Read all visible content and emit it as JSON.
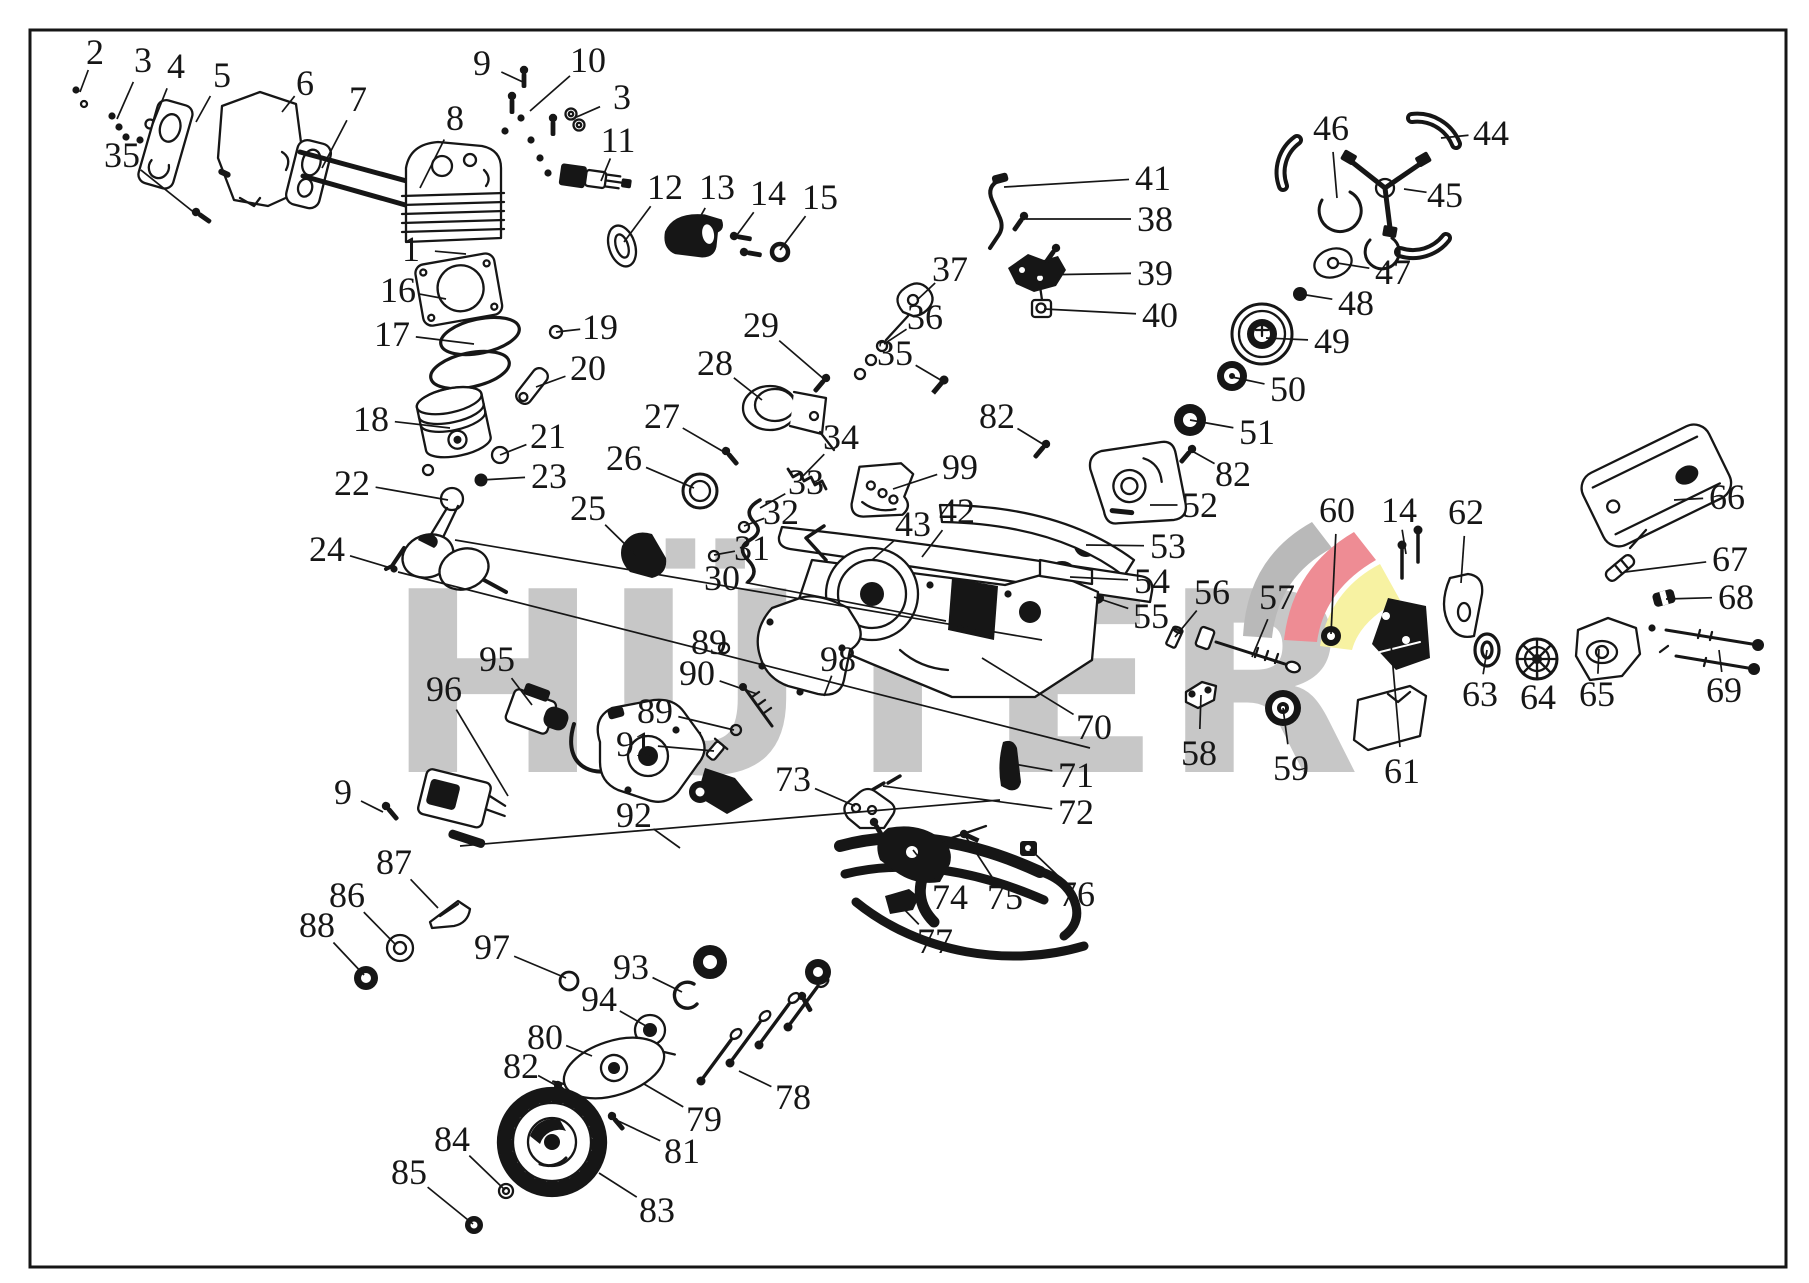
{
  "diagram": {
    "type": "exploded-parts-diagram",
    "subject": "chainsaw engine parts",
    "watermark": {
      "text": "HÜTER",
      "color": "#c7c7c7"
    },
    "logo_colors": {
      "gray": "#b9b9b9",
      "red": "#ee8c94",
      "yellow": "#f7f2a2"
    },
    "line_color": "#161616",
    "background": "#ffffff",
    "callouts": [
      {
        "n": "2",
        "l": [
          95,
          52
        ],
        "p": [
          80,
          92
        ]
      },
      {
        "n": "3",
        "l": [
          143,
          60
        ],
        "p": [
          117,
          119
        ]
      },
      {
        "n": "4",
        "l": [
          176,
          66
        ],
        "p": [
          152,
          126
        ]
      },
      {
        "n": "5",
        "l": [
          222,
          75
        ],
        "p": [
          196,
          122
        ]
      },
      {
        "n": "6",
        "l": [
          305,
          83
        ],
        "p": [
          282,
          112
        ]
      },
      {
        "n": "7",
        "l": [
          358,
          99
        ],
        "p": [
          322,
          168
        ]
      },
      {
        "n": "8",
        "l": [
          455,
          118
        ],
        "p": [
          420,
          188
        ]
      },
      {
        "n": "35",
        "l": [
          122,
          155
        ],
        "p": [
          196,
          214
        ]
      },
      {
        "n": "9",
        "l": [
          482,
          63
        ],
        "p": [
          525,
          83
        ]
      },
      {
        "n": "10",
        "l": [
          588,
          60
        ],
        "p": [
          530,
          111
        ]
      },
      {
        "n": "3",
        "l": [
          622,
          97
        ],
        "p": [
          572,
          119
        ]
      },
      {
        "n": "11",
        "l": [
          618,
          140
        ],
        "p": [
          601,
          181
        ]
      },
      {
        "n": "12",
        "l": [
          665,
          187
        ],
        "p": [
          624,
          242
        ]
      },
      {
        "n": "13",
        "l": [
          717,
          187
        ],
        "p": [
          686,
          242
        ]
      },
      {
        "n": "14",
        "l": [
          768,
          193
        ],
        "p": [
          734,
          239
        ]
      },
      {
        "n": "15",
        "l": [
          820,
          197
        ],
        "p": [
          780,
          250
        ]
      },
      {
        "n": "1",
        "l": [
          411,
          249
        ],
        "p": [
          466,
          254
        ]
      },
      {
        "n": "16",
        "l": [
          398,
          290
        ],
        "p": [
          446,
          299
        ]
      },
      {
        "n": "17",
        "l": [
          392,
          334
        ],
        "p": [
          474,
          344
        ]
      },
      {
        "n": "18",
        "l": [
          371,
          419
        ],
        "p": [
          450,
          428
        ]
      },
      {
        "n": "19",
        "l": [
          600,
          327
        ],
        "p": [
          556,
          332
        ]
      },
      {
        "n": "20",
        "l": [
          588,
          368
        ],
        "p": [
          536,
          387
        ]
      },
      {
        "n": "21",
        "l": [
          548,
          436
        ],
        "p": [
          500,
          455
        ]
      },
      {
        "n": "23",
        "l": [
          549,
          476
        ],
        "p": [
          481,
          480
        ]
      },
      {
        "n": "22",
        "l": [
          352,
          483
        ],
        "p": [
          448,
          500
        ]
      },
      {
        "n": "24",
        "l": [
          327,
          549
        ],
        "p": [
          394,
          569
        ]
      },
      {
        "n": "25",
        "l": [
          588,
          508
        ],
        "p": [
          636,
          555
        ]
      },
      {
        "n": "26",
        "l": [
          624,
          458
        ],
        "p": [
          694,
          488
        ]
      },
      {
        "n": "27",
        "l": [
          662,
          416
        ],
        "p": [
          724,
          452
        ]
      },
      {
        "n": "28",
        "l": [
          715,
          363
        ],
        "p": [
          762,
          400
        ]
      },
      {
        "n": "29",
        "l": [
          761,
          325
        ],
        "p": [
          825,
          380
        ]
      },
      {
        "n": "34",
        "l": [
          841,
          437
        ],
        "p": [
          802,
          477
        ]
      },
      {
        "n": "33",
        "l": [
          806,
          482
        ],
        "p": [
          760,
          508
        ]
      },
      {
        "n": "32",
        "l": [
          781,
          512
        ],
        "p": [
          744,
          526
        ]
      },
      {
        "n": "31",
        "l": [
          752,
          548
        ],
        "p": [
          714,
          555
        ]
      },
      {
        "n": "30",
        "l": [
          722,
          578
        ],
        "p": [
          946,
          621
        ]
      },
      {
        "n": "43",
        "l": [
          913,
          524
        ],
        "p": [
          872,
          560
        ]
      },
      {
        "n": "42",
        "l": [
          957,
          511
        ],
        "p": [
          922,
          557
        ]
      },
      {
        "n": "99",
        "l": [
          960,
          467
        ],
        "p": [
          893,
          489
        ]
      },
      {
        "n": "82",
        "l": [
          997,
          416
        ],
        "p": [
          1046,
          446
        ]
      },
      {
        "n": "82",
        "l": [
          1233,
          474
        ],
        "p": [
          1192,
          451
        ]
      },
      {
        "n": "37",
        "l": [
          950,
          269
        ],
        "p": [
          917,
          300
        ]
      },
      {
        "n": "36",
        "l": [
          925,
          317
        ],
        "p": [
          884,
          344
        ]
      },
      {
        "n": "35",
        "l": [
          895,
          353
        ],
        "p": [
          944,
          382
        ]
      },
      {
        "n": "41",
        "l": [
          1153,
          178
        ],
        "p": [
          1004,
          187
        ]
      },
      {
        "n": "38",
        "l": [
          1155,
          219
        ],
        "p": [
          1026,
          219
        ]
      },
      {
        "n": "39",
        "l": [
          1155,
          273
        ],
        "p": [
          1034,
          275
        ]
      },
      {
        "n": "40",
        "l": [
          1160,
          315
        ],
        "p": [
          1044,
          309
        ]
      },
      {
        "n": "46",
        "l": [
          1331,
          128
        ],
        "p": [
          1337,
          198
        ]
      },
      {
        "n": "44",
        "l": [
          1491,
          133
        ],
        "p": [
          1441,
          138
        ]
      },
      {
        "n": "45",
        "l": [
          1445,
          195
        ],
        "p": [
          1404,
          189
        ]
      },
      {
        "n": "47",
        "l": [
          1393,
          272
        ],
        "p": [
          1337,
          263
        ]
      },
      {
        "n": "48",
        "l": [
          1356,
          303
        ],
        "p": [
          1300,
          294
        ]
      },
      {
        "n": "49",
        "l": [
          1332,
          341
        ],
        "p": [
          1266,
          338
        ]
      },
      {
        "n": "50",
        "l": [
          1288,
          389
        ],
        "p": [
          1232,
          377
        ]
      },
      {
        "n": "51",
        "l": [
          1257,
          432
        ],
        "p": [
          1190,
          420
        ]
      },
      {
        "n": "52",
        "l": [
          1200,
          505
        ],
        "p": [
          1150,
          505
        ]
      },
      {
        "n": "53",
        "l": [
          1168,
          546
        ],
        "p": [
          1086,
          545
        ]
      },
      {
        "n": "54",
        "l": [
          1152,
          581
        ],
        "p": [
          1070,
          577
        ]
      },
      {
        "n": "55",
        "l": [
          1151,
          616
        ],
        "p": [
          1094,
          597
        ]
      },
      {
        "n": "56",
        "l": [
          1212,
          592
        ],
        "p": [
          1175,
          637
        ]
      },
      {
        "n": "57",
        "l": [
          1277,
          597
        ],
        "p": [
          1252,
          657
        ]
      },
      {
        "n": "60",
        "l": [
          1337,
          510
        ],
        "p": [
          1331,
          634
        ]
      },
      {
        "n": "14",
        "l": [
          1399,
          510
        ],
        "p": [
          1406,
          554
        ]
      },
      {
        "n": "62",
        "l": [
          1466,
          512
        ],
        "p": [
          1461,
          583
        ]
      },
      {
        "n": "66",
        "l": [
          1727,
          497
        ],
        "p": [
          1674,
          500
        ]
      },
      {
        "n": "67",
        "l": [
          1730,
          559
        ],
        "p": [
          1625,
          572
        ]
      },
      {
        "n": "68",
        "l": [
          1736,
          597
        ],
        "p": [
          1666,
          599
        ]
      },
      {
        "n": "69",
        "l": [
          1724,
          690
        ],
        "p": [
          1719,
          650
        ]
      },
      {
        "n": "63",
        "l": [
          1480,
          694
        ],
        "p": [
          1487,
          650
        ]
      },
      {
        "n": "64",
        "l": [
          1538,
          697
        ],
        "p": [
          1537,
          660
        ]
      },
      {
        "n": "65",
        "l": [
          1597,
          694
        ],
        "p": [
          1599,
          649
        ]
      },
      {
        "n": "58",
        "l": [
          1199,
          753
        ],
        "p": [
          1201,
          695
        ]
      },
      {
        "n": "59",
        "l": [
          1291,
          768
        ],
        "p": [
          1283,
          708
        ]
      },
      {
        "n": "61",
        "l": [
          1402,
          771
        ],
        "p": [
          1391,
          644
        ]
      },
      {
        "n": "70",
        "l": [
          1094,
          727
        ],
        "p": [
          982,
          658
        ]
      },
      {
        "n": "71",
        "l": [
          1076,
          775
        ],
        "p": [
          1014,
          764
        ]
      },
      {
        "n": "72",
        "l": [
          1076,
          812
        ],
        "p": [
          883,
          786
        ]
      },
      {
        "n": "89",
        "l": [
          709,
          642
        ],
        "p": [
          723,
          648
        ]
      },
      {
        "n": "90",
        "l": [
          697,
          673
        ],
        "p": [
          757,
          694
        ]
      },
      {
        "n": "89",
        "l": [
          655,
          711
        ],
        "p": [
          734,
          730
        ]
      },
      {
        "n": "91",
        "l": [
          634,
          744
        ],
        "p": [
          714,
          751
        ]
      },
      {
        "n": "98",
        "l": [
          838,
          659
        ],
        "p": [
          824,
          696
        ]
      },
      {
        "n": "95",
        "l": [
          497,
          659
        ],
        "p": [
          532,
          705
        ]
      },
      {
        "n": "96",
        "l": [
          444,
          689
        ],
        "p": [
          508,
          796
        ]
      },
      {
        "n": "9",
        "l": [
          343,
          792
        ],
        "p": [
          383,
          812
        ]
      },
      {
        "n": "87",
        "l": [
          394,
          862
        ],
        "p": [
          438,
          908
        ]
      },
      {
        "n": "86",
        "l": [
          347,
          895
        ],
        "p": [
          396,
          945
        ]
      },
      {
        "n": "88",
        "l": [
          317,
          925
        ],
        "p": [
          364,
          975
        ]
      },
      {
        "n": "97",
        "l": [
          492,
          947
        ],
        "p": [
          566,
          978
        ]
      },
      {
        "n": "93",
        "l": [
          631,
          967
        ],
        "p": [
          682,
          992
        ]
      },
      {
        "n": "94",
        "l": [
          599,
          999
        ],
        "p": [
          646,
          1026
        ]
      },
      {
        "n": "92",
        "l": [
          634,
          815
        ],
        "p": [
          680,
          848
        ]
      },
      {
        "n": "73",
        "l": [
          793,
          779
        ],
        "p": [
          855,
          806
        ]
      },
      {
        "n": "74",
        "l": [
          950,
          897
        ],
        "p": [
          913,
          850
        ]
      },
      {
        "n": "75",
        "l": [
          1005,
          897
        ],
        "p": [
          964,
          834
        ]
      },
      {
        "n": "76",
        "l": [
          1077,
          894
        ],
        "p": [
          1030,
          849
        ]
      },
      {
        "n": "77",
        "l": [
          935,
          941
        ],
        "p": [
          899,
          904
        ]
      },
      {
        "n": "78",
        "l": [
          793,
          1097
        ],
        "p": [
          739,
          1071
        ]
      },
      {
        "n": "79",
        "l": [
          704,
          1119
        ],
        "p": [
          644,
          1084
        ]
      },
      {
        "n": "81",
        "l": [
          682,
          1151
        ],
        "p": [
          614,
          1119
        ]
      },
      {
        "n": "80",
        "l": [
          545,
          1037
        ],
        "p": [
          592,
          1056
        ]
      },
      {
        "n": "82",
        "l": [
          521,
          1066
        ],
        "p": [
          559,
          1087
        ]
      },
      {
        "n": "84",
        "l": [
          452,
          1139
        ],
        "p": [
          505,
          1190
        ]
      },
      {
        "n": "85",
        "l": [
          409,
          1172
        ],
        "p": [
          473,
          1224
        ]
      },
      {
        "n": "83",
        "l": [
          657,
          1210
        ],
        "p": [
          599,
          1173
        ]
      }
    ],
    "extra_lines": [
      [
        398,
        572,
        1090,
        748
      ],
      [
        455,
        540,
        1042,
        640
      ],
      [
        460,
        846,
        1000,
        800
      ]
    ]
  }
}
